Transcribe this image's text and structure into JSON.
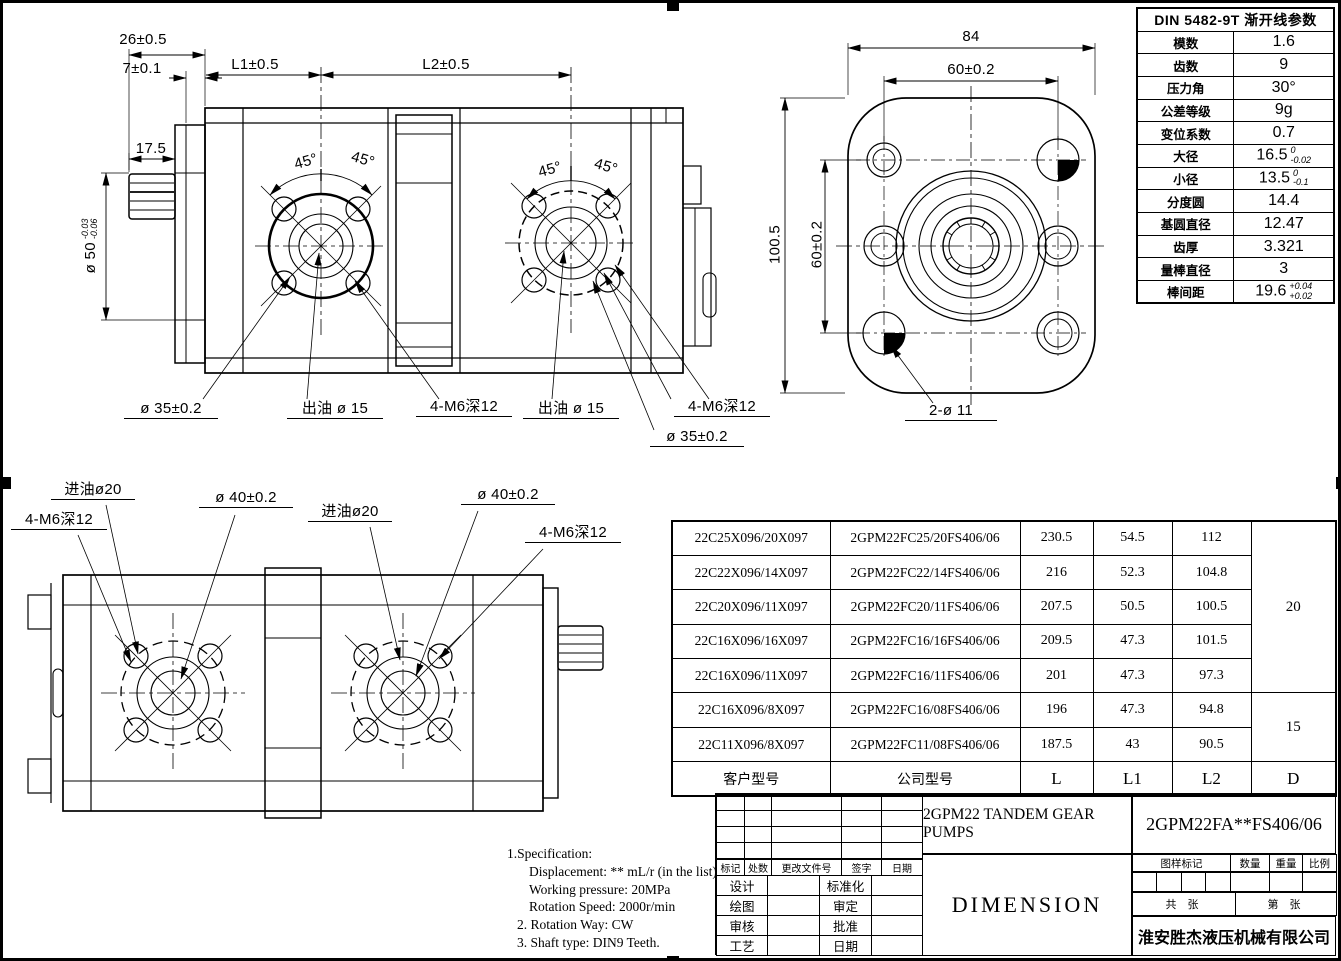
{
  "sheet": {
    "company": "淮安胜杰液压机械有限公司",
    "product_title": "2GPM22 TANDEM GEAR PUMPS",
    "sheet_title": "DIMENSION",
    "part_number": "2GPM22FA**FS406/06"
  },
  "din_table": {
    "title": "DIN 5482-9T 渐开线参数",
    "rows": [
      {
        "label": "模数",
        "value": "1.6"
      },
      {
        "label": "齿数",
        "value": "9"
      },
      {
        "label": "压力角",
        "value": "30°"
      },
      {
        "label": "公差等级",
        "value": "9g"
      },
      {
        "label": "变位系数",
        "value": "0.7"
      },
      {
        "label": "大径",
        "value": "16.5",
        "tol_up": "0",
        "tol_dn": "-0.02"
      },
      {
        "label": "小径",
        "value": "13.5",
        "tol_up": "0",
        "tol_dn": "-0.1"
      },
      {
        "label": "分度圆",
        "value": "14.4"
      },
      {
        "label": "基圆直径",
        "value": "12.47"
      },
      {
        "label": "齿厚",
        "value": "3.321"
      },
      {
        "label": "量棒直径",
        "value": "3"
      },
      {
        "label": "棒间距",
        "value": "19.6",
        "tol_up": "+0.04",
        "tol_dn": "+0.02"
      }
    ]
  },
  "model_table": {
    "col_headers": {
      "customer": "客户型号",
      "company": "公司型号",
      "l": "L",
      "l1": "L1",
      "l2": "L2",
      "d": "D"
    },
    "rows": [
      {
        "customer": "22C25X096/20X097",
        "company": "2GPM22FC25/20FS406/06",
        "l": "230.5",
        "l1": "54.5",
        "l2": "112"
      },
      {
        "customer": "22C22X096/14X097",
        "company": "2GPM22FC22/14FS406/06",
        "l": "216",
        "l1": "52.3",
        "l2": "104.8"
      },
      {
        "customer": "22C20X096/11X097",
        "company": "2GPM22FC20/11FS406/06",
        "l": "207.5",
        "l1": "50.5",
        "l2": "100.5"
      },
      {
        "customer": "22C16X096/16X097",
        "company": "2GPM22FC16/16FS406/06",
        "l": "209.5",
        "l1": "47.3",
        "l2": "101.5"
      },
      {
        "customer": "22C16X096/11X097",
        "company": "2GPM22FC16/11FS406/06",
        "l": "201",
        "l1": "47.3",
        "l2": "97.3"
      },
      {
        "customer": "22C16X096/8X097",
        "company": "2GPM22FC16/08FS406/06",
        "l": "196",
        "l1": "47.3",
        "l2": "94.8"
      },
      {
        "customer": "22C11X096/8X097",
        "company": "2GPM22FC11/08FS406/06",
        "l": "187.5",
        "l1": "43",
        "l2": "90.5"
      }
    ],
    "d_top": "20",
    "d_bottom": "15"
  },
  "front_view": {
    "dim_26": "26±0.5",
    "dim_7": "7±0.1",
    "dim_l1": "L1±0.5",
    "dim_l2": "L2±0.5",
    "dim_17_5": "17.5",
    "dim_shaft": "ø 50",
    "shaft_tol_up": "-0.03",
    "shaft_tol_dn": "-0.06",
    "angle_45": "45°",
    "dim_35": "ø 35±0.2",
    "outlet": "出油 ø 15",
    "thread": "4-M6深12"
  },
  "face_view": {
    "dim_84": "84",
    "dim_60h": "60±0.2",
    "dim_100_5": "100.5",
    "dim_60v": "60±0.2",
    "dim_2x11": "2-ø 11"
  },
  "bottom_view": {
    "inlet": "进油ø20",
    "thread": "4-M6深12",
    "dim_40": "ø 40±0.2"
  },
  "notes": {
    "line1": "1.Specification:",
    "line2": "Displacement: ** mL/r (in the list)",
    "line3": "Working pressure: 20MPa",
    "line4": "Rotation Speed: 2000r/min",
    "line5": "2. Rotation Way: CW",
    "line6": "3. Shaft type: DIN9 Teeth."
  },
  "title_block": {
    "rev_headers": [
      "标记",
      "处数",
      "更改文件号",
      "签字",
      "日期"
    ],
    "roles": [
      {
        "left": "设计",
        "right": "标准化"
      },
      {
        "left": "绘图",
        "right": "审定"
      },
      {
        "left": "审核",
        "right": "批准"
      },
      {
        "left": "工艺",
        "right": "日期"
      }
    ],
    "stamp": {
      "mark": "图样标记",
      "qty": "数量",
      "weight": "重量",
      "scale": "比例"
    },
    "sheets": {
      "total": "共  张",
      "number": "第  张"
    }
  }
}
